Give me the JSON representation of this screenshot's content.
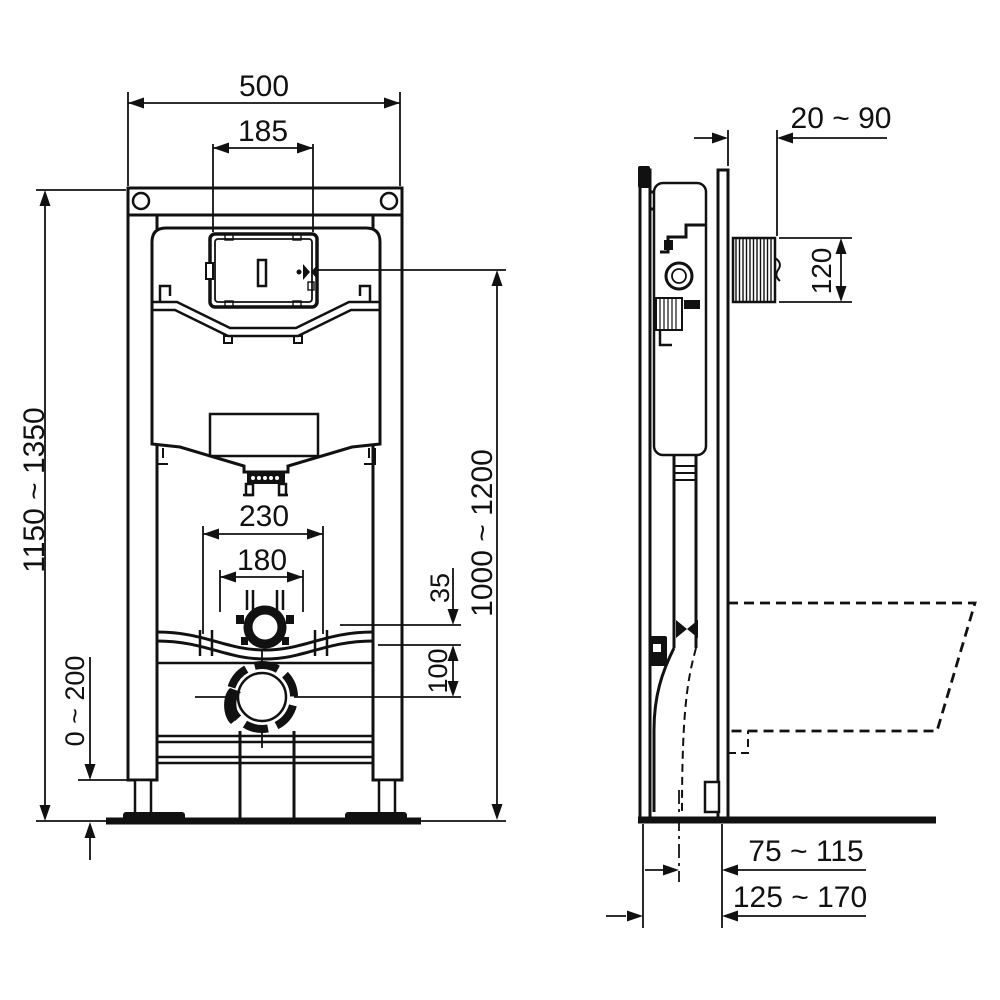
{
  "colors": {
    "ink": "#111111",
    "paper": "#ffffff"
  },
  "dims": {
    "frame_width": "500",
    "service_opening_width": "185",
    "bowl_fixing_spacing": "230",
    "flush_pipe_spacing": "180",
    "flush_pipe_offset": "35",
    "outlet_offset": "100",
    "foot_adjustment": "0 ~ 200",
    "frame_height": "1150 ~ 1350",
    "actuation_height": "1000 ~ 1200",
    "wall_finish_depth": "20 ~ 90",
    "service_opening_height": "120",
    "outlet_to_wall": "75 ~ 115",
    "outlet_depth": "125 ~ 170"
  }
}
